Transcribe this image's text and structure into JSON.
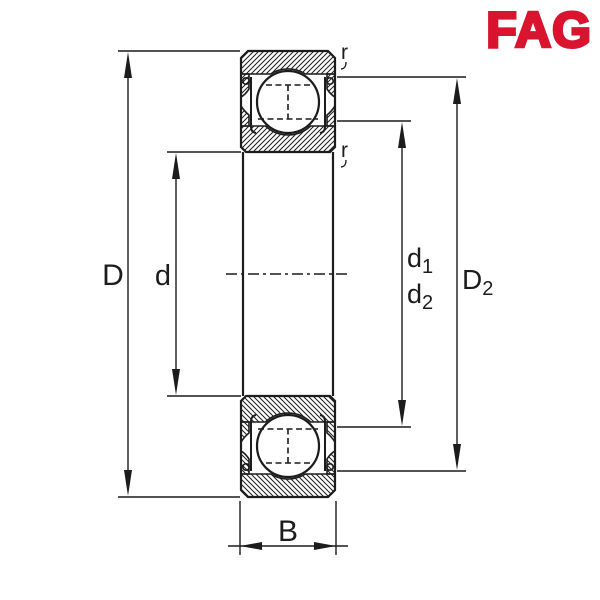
{
  "brand": {
    "logo_text": "FAG",
    "logo_color": "#d8142f"
  },
  "diagram": {
    "type": "deep-groove-ball-bearing-cross-section",
    "line_color": "#1c1c1c",
    "background_color": "#ffffff",
    "dimensions": {
      "outer_diameter_label": "D",
      "bore_diameter_label": "d",
      "d1": {
        "base": "d",
        "sub": "1"
      },
      "d2": {
        "base": "d",
        "sub": "2"
      },
      "D2": {
        "base": "D",
        "sub": "2"
      },
      "width_label": "B",
      "chamfer_outer_label": "r",
      "chamfer_inner_label": "r"
    }
  }
}
